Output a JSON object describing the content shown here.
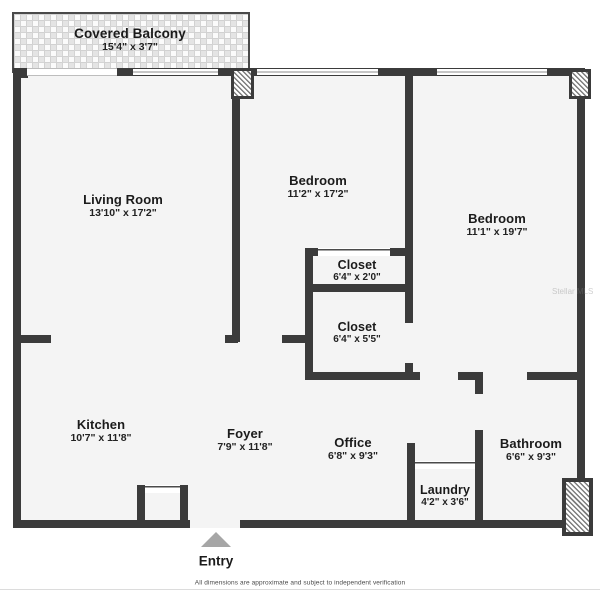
{
  "balcony": {
    "name": "Covered Balcony",
    "dims": "15'4\" x 3'7\""
  },
  "rooms": [
    {
      "name": "Living Room",
      "dims": "13'10\" x 17'2\""
    },
    {
      "name": "Bedroom",
      "dims": "11'2\" x 17'2\""
    },
    {
      "name": "Bedroom",
      "dims": "11'1\" x 19'7\""
    },
    {
      "name": "Closet",
      "dims": "6'4\" x 2'0\""
    },
    {
      "name": "Closet",
      "dims": "6'4\" x 5'5\""
    },
    {
      "name": "Kitchen",
      "dims": "10'7\" x 11'8\""
    },
    {
      "name": "Foyer",
      "dims": "7'9\" x 11'8\""
    },
    {
      "name": "Office",
      "dims": "6'8\" x 9'3\""
    },
    {
      "name": "Bathroom",
      "dims": "6'6\" x 9'3\""
    },
    {
      "name": "Laundry",
      "dims": "4'2\" x 3'6\""
    }
  ],
  "entry": {
    "label": "Entry"
  },
  "footer": {
    "text": "All dimensions are approximate and subject to independent verification"
  },
  "watermark": {
    "text": "Stellar MLS"
  },
  "colors": {
    "wall": "#3b3b3b",
    "room_fill": "#f4f4f4",
    "entry_arrow": "#a6a6a6"
  }
}
